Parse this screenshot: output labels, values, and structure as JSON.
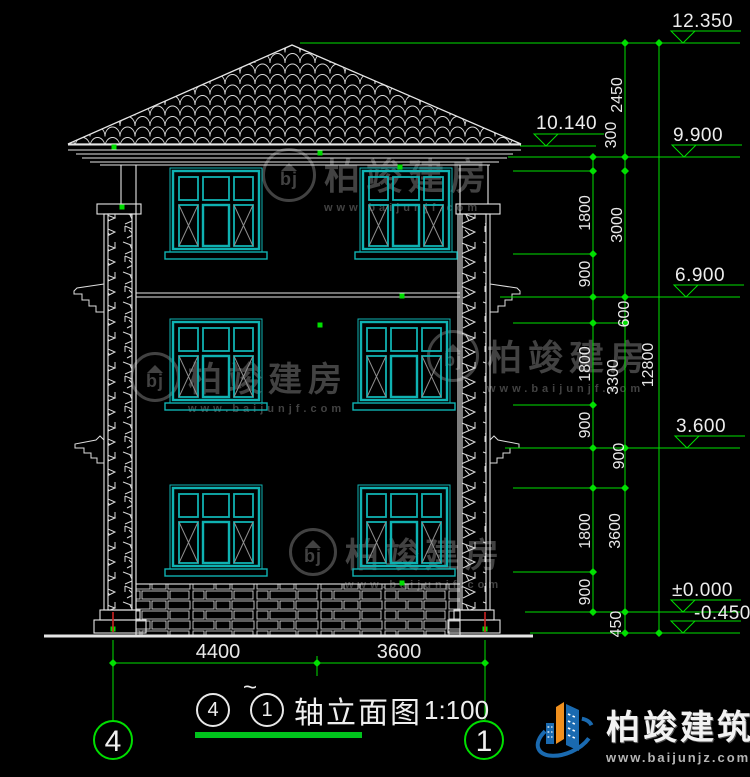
{
  "drawing_title": {
    "axis_start": "4",
    "tilde": "~",
    "axis_end": "1",
    "name": "轴立面图",
    "scale": "1:100"
  },
  "axis_bubbles": {
    "left": "4",
    "right": "1"
  },
  "dims": {
    "bottom": [
      "4400",
      "3600"
    ],
    "chain_inner": [
      "1800",
      "900",
      "1800",
      "900",
      "1800",
      "900"
    ],
    "chain_mid": [
      "2450",
      "300",
      "3000",
      "600",
      "3300",
      "900",
      "3600",
      "450"
    ],
    "chain_outer": [
      "12800"
    ]
  },
  "elevations": {
    "ridge": "12.350",
    "eave_top": "10.140",
    "eave": "9.900",
    "floor3": "6.900",
    "floor2": "3.600",
    "ground": "±0.000",
    "site": "-0.450"
  },
  "watermark": {
    "name": "柏竣建房",
    "url": "www.baijunjf.com",
    "monogram": "bj"
  },
  "logo": {
    "name": "柏竣建筑",
    "url": "www.baijunjz.com"
  },
  "colors": {
    "background": "#000000",
    "line": "#e6e6e6",
    "window": "#0fb2b2",
    "dimension": "#00df00",
    "watermark": "#424242",
    "axis_red": "#cc2222",
    "logo_blue": "#1a6ab0",
    "logo_orange": "#f0901e"
  }
}
